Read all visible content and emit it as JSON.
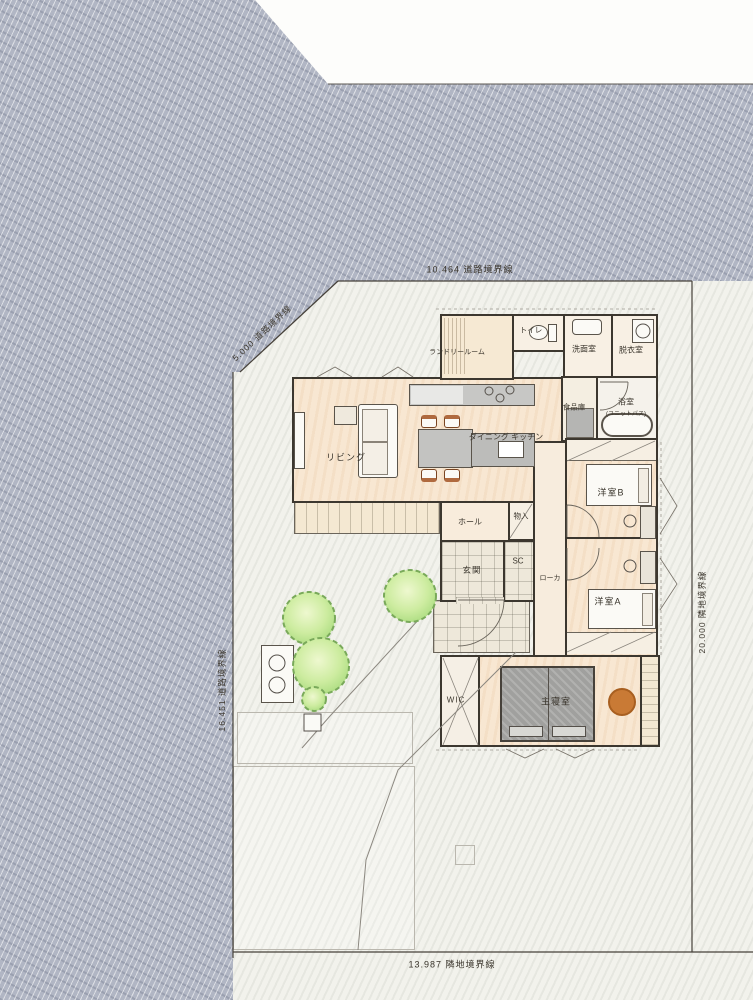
{
  "plan": {
    "boundaries": {
      "top": "10.464 道路境界線",
      "left_diagonal": "5.000 道路境界線",
      "left": "16.451 道路境界線",
      "right": "20.000 隣地境界線",
      "bottom": "13.987 隣地境界線"
    },
    "rooms": {
      "living": "リビング",
      "dining_kitchen": "ダイニング キッチン",
      "laundry": "ランドリールーム",
      "toilet": "トイレ",
      "washroom": "洗面室",
      "dressing": "脱衣室",
      "pantry": "食品庫",
      "bath": "浴室",
      "bath_sub": "(ユニットバス)",
      "western_b": "洋室B",
      "western_a": "洋室A",
      "hall": "ホール",
      "storage": "物入",
      "entrance": "玄関",
      "shoe_closet": "SC",
      "corridor": "ローカ",
      "wic": "WIC",
      "master": "主寝室"
    },
    "colors": {
      "road": "#b1b6c4",
      "site": "#f2f2ec",
      "wall": "#3c372f",
      "floor": "#f8e7d2",
      "furniture_gray": "#c3c3c1",
      "bed_gray": "#9d9d9b",
      "accent_orange": "#c97a35",
      "tree_green": "#cdeca0"
    }
  }
}
